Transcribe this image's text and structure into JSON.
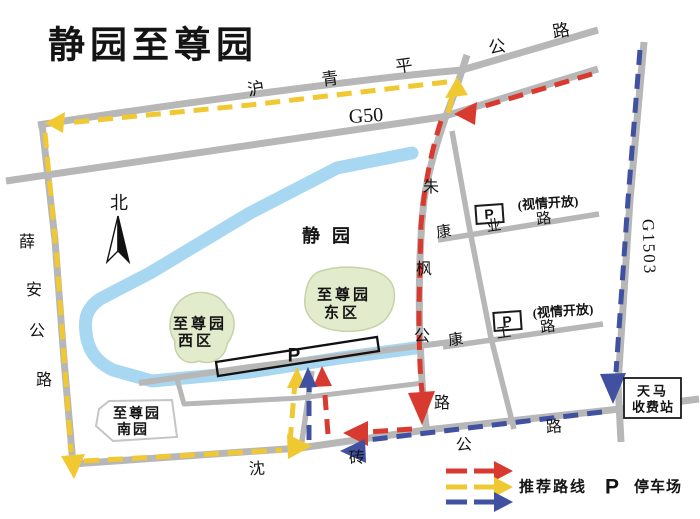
{
  "title": "静园至尊园",
  "compass_label": "北",
  "roads": {
    "huqingping": {
      "name": "沪青平公路",
      "chars": [
        "沪",
        "青",
        "平",
        "公",
        "路"
      ]
    },
    "g50_label": "G50",
    "xuean": {
      "name": "薛安公路",
      "chars": [
        "薛",
        "安",
        "公",
        "路"
      ]
    },
    "zhufeng": {
      "name": "朱枫公路",
      "chars": [
        "朱",
        "枫",
        "公",
        "路"
      ]
    },
    "g1503_label": "G1503",
    "kangye": {
      "name": "康业路",
      "chars": [
        "康",
        "业",
        "路"
      ]
    },
    "kanggong": {
      "name": "康工路",
      "chars": [
        "康",
        "工",
        "路"
      ]
    },
    "shenzhuan": {
      "name": "沈砖公路",
      "chars": [
        "沈",
        "砖",
        "公",
        "路"
      ]
    }
  },
  "areas": {
    "jingyuan_label": "静园",
    "east_line1": "至尊园",
    "east_line2": "东区",
    "west_line1": "至尊园",
    "west_line2": "西区",
    "south_line1": "至尊园",
    "south_line2": "南园"
  },
  "toll_station": {
    "line1": "天马",
    "line2": "收费站"
  },
  "parking": {
    "lot_p": "P",
    "p1_label": "P",
    "p1_note": "(视情开放)",
    "p2_label": "P",
    "p2_note": "(视情开放)"
  },
  "legend": {
    "route_label": "推荐路线",
    "parking_symbol": "P",
    "parking_label": "停车场"
  },
  "colors": {
    "road": "#b7b7b7",
    "river": "#a8d7f1",
    "green_area": "#e3ebcd",
    "route_red": "#d93a30",
    "route_yellow": "#f0c832",
    "route_blue": "#3f51a0"
  }
}
